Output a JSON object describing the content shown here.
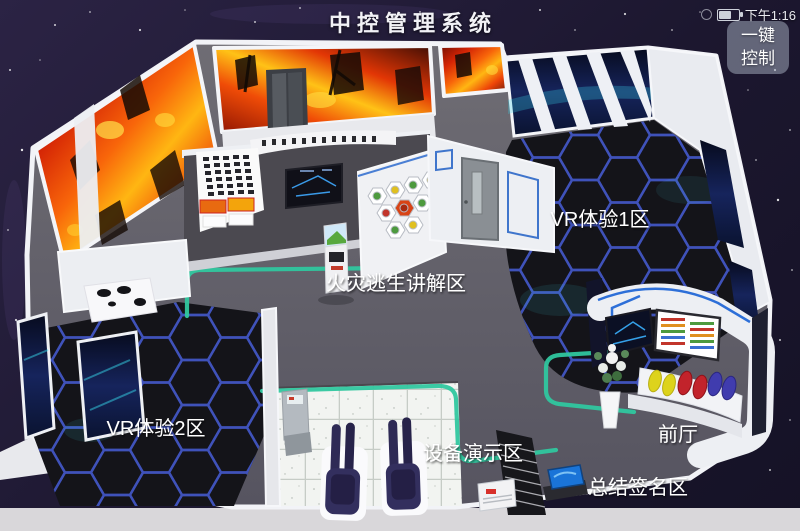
{
  "header": {
    "title": "中控管理系统",
    "status": {
      "time": "下午1:16",
      "icons": {
        "battery": "battery-icon",
        "signal": "signal-icon"
      },
      "battery_level_pct": 60
    },
    "control_button": {
      "label": "一键控制",
      "line1": "一键",
      "line2": "控制"
    }
  },
  "map": {
    "description_style": "3d-isometric-floorplan",
    "zones": [
      {
        "id": "vr-experience-1",
        "label": "VR体验1区"
      },
      {
        "id": "fire-escape-briefing",
        "label": "火灾逃生讲解区"
      },
      {
        "id": "vr-experience-2",
        "label": "VR体验2区"
      },
      {
        "id": "equipment-demo",
        "label": "设备演示区"
      },
      {
        "id": "lobby",
        "label": "前厅"
      },
      {
        "id": "summary-signature",
        "label": "总结签名区"
      }
    ],
    "colors": {
      "route": "#30c79f",
      "hex_floor_line": "#4358cc",
      "fire": [
        "#ffb612",
        "#f8650a",
        "#d42405"
      ],
      "background": "#221c38",
      "wall_trim_blue": "#2d6fd8"
    }
  }
}
